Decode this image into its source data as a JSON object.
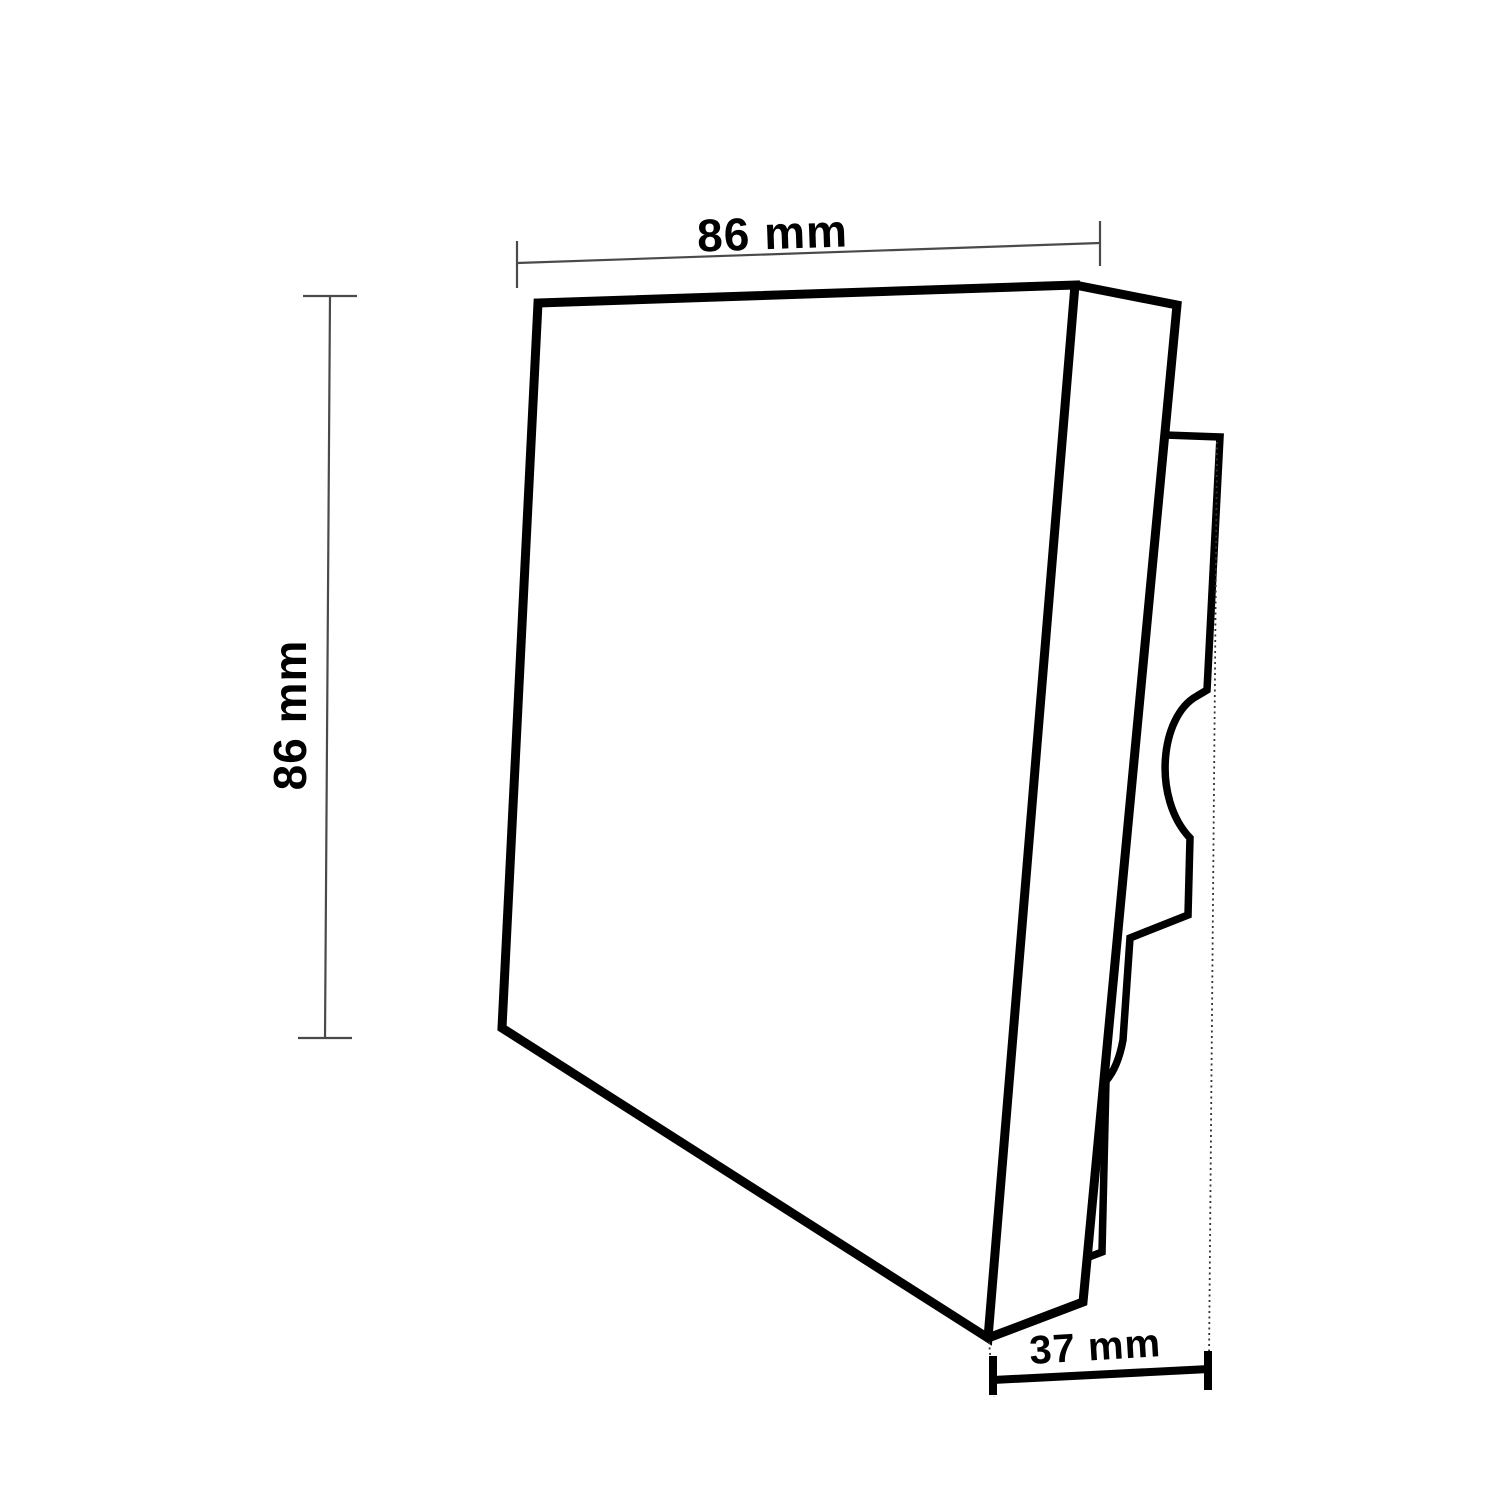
{
  "drawing": {
    "type": "technical-dimension-diagram",
    "subject": "wall-switch-panel-three-quarter-view",
    "labels": {
      "width_top": "86 mm",
      "height_left": "86 mm",
      "depth_bottom": "37 mm"
    },
    "values_mm": {
      "width": 86,
      "height": 86,
      "depth": 37
    },
    "colors": {
      "outline": "#000000",
      "dim_thin": "#4a4a4a",
      "dim_thick": "#000000",
      "extension": "#333333",
      "text": "#000000",
      "background": "#ffffff"
    }
  }
}
